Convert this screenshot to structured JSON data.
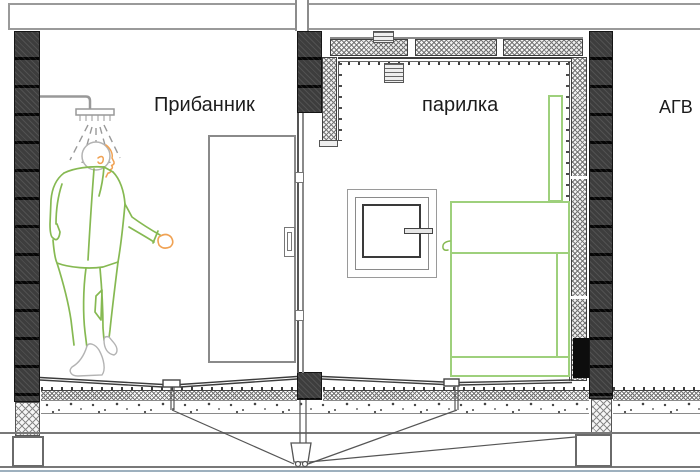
{
  "labels": {
    "room_left": "Прибанник",
    "room_middle": "парилка",
    "area_right": "АГВ"
  },
  "colors": {
    "figure_green": "#86b952",
    "stove_green": "#9ed07c",
    "skin_orange": "#f0a254",
    "wall_dark": "#3d3d3d",
    "line_gray": "#999999",
    "line_dark": "#3c3c3c",
    "ground_blue": "#9db0be"
  }
}
